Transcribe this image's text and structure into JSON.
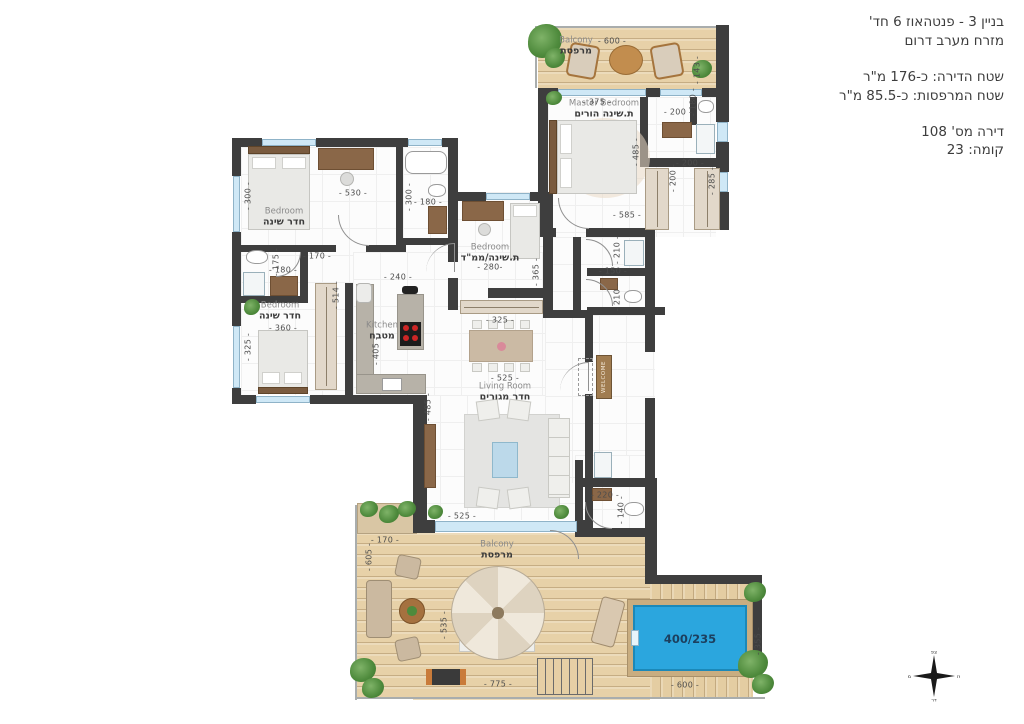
{
  "title_block": {
    "building": "בניין 3 - פנטהאוז 6 חד'",
    "orientation": "מזרח מערב דרום",
    "apartment_area": "שטח הדירה: כ-176 מ\"ר",
    "balcony_area": "שטח המרפסות: כ-85.5 מ\"ר",
    "apartment_no": "דירה מס' 108",
    "floor": "קומה: 23"
  },
  "rooms": {
    "balcony_top": {
      "en": "Balcony",
      "he": "מרפסת"
    },
    "master_bedroom": {
      "en": "Master Bedroom",
      "he": "ת.שינה הורים"
    },
    "bedroom_top_left": {
      "en": "Bedroom",
      "he": "חדר שינה"
    },
    "bedroom_safe": {
      "en": "Bedroom",
      "he": "ת.שינה/ממ\"ד"
    },
    "bedroom_bottom_left": {
      "en": "Bedroom",
      "he": "חדר שינה"
    },
    "kitchen": {
      "en": "Kitchen",
      "he": "מטבח"
    },
    "living_room": {
      "en": "Living Room",
      "he": "חדר מגורים"
    },
    "balcony_bottom": {
      "en": "Balcony",
      "he": "מרפסת"
    }
  },
  "labels": {
    "welcome": "WELCOME",
    "pool": "400/235"
  },
  "compass": {
    "north": "צפ",
    "south": "דר",
    "east": "מז",
    "west": "מע"
  },
  "dims": {
    "balcony_top_w": "- 600 -",
    "balcony_top_d": "- 143 -",
    "master_top": "- 375 -",
    "master_right": "- 485 -",
    "master_bottom": "- 585 -",
    "mbath_w": "- 200 -",
    "mbath_d": "- 180 -",
    "mcloset_a": "- 200 -",
    "mcloset_b": "- 200 -",
    "mcloset_c": "- 285 -",
    "bed1_top": "- 530 -",
    "bed1_left": "- 300 -",
    "bath1_left": "- 300 -",
    "bath1_w": "- 180 -",
    "hall_top": "- 170 -",
    "bath2_left": "- 175 -",
    "bath2_w": "- 180 -",
    "bed2_top": "- 360 -",
    "bed2_left": "- 325 -",
    "hall_left": "- 514 -",
    "kitchen_top": "- 240 -",
    "kitchen_left": "- 405 -",
    "living_left": "- 485 -",
    "safe_w": "- 280-",
    "safe_d": "- 365 -",
    "safe_bottom": "- 325 -",
    "bath3_d": "- 210 -",
    "bath3_w": "- 150 -",
    "bath4_d": "- 210 -",
    "living_top": "- 525 -",
    "living_bottom": "- 525 -",
    "bath5_w": "- 220 -",
    "bath5_d": "- 140 -",
    "terrace_top": "- 170 -",
    "terrace_left": "- 605 -",
    "terrace_mid": "- 535 -",
    "terrace_bottom": "- 775 -",
    "pool_deck_w": "- 600 -",
    "pool_deck_d": "- 355 -"
  }
}
